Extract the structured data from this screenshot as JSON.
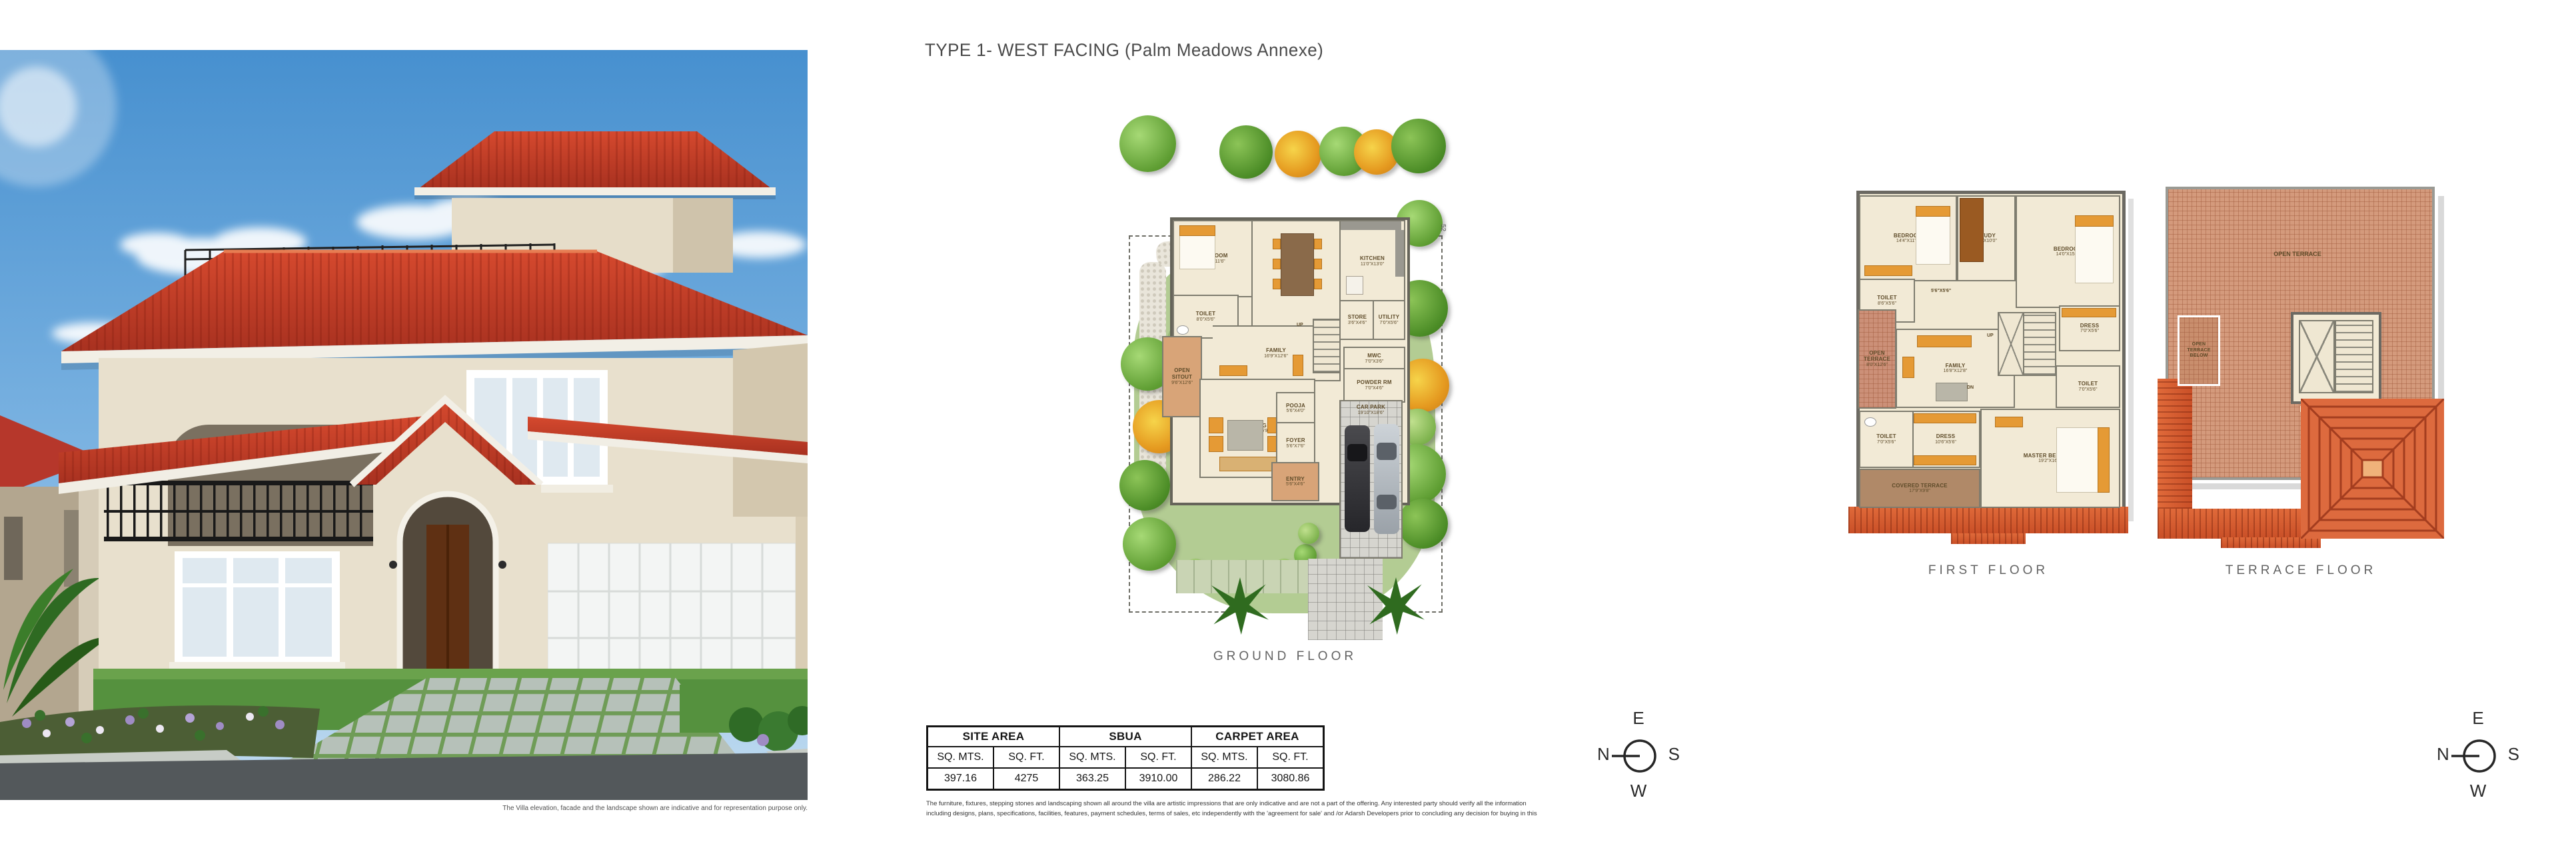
{
  "page_title": "TYPE 1- WEST FACING (Palm Meadows Annexe)",
  "villa": {
    "caption": "The Villa elevation, facade and the landscape shown are indicative and for representation purpose only."
  },
  "floors": {
    "ground": {
      "label": "GROUND FLOOR",
      "plot_no": "52"
    },
    "first": {
      "label": "FIRST FLOOR"
    },
    "terrace": {
      "label": "TERRACE FLOOR"
    }
  },
  "ground_rooms": [
    {
      "name": "BEDROOM",
      "dims": "12'6\"X11'6\""
    },
    {
      "name": "TOILET",
      "dims": "8'0\"X5'6\""
    },
    {
      "name": "DINING",
      "dims": "12'0\"X17'4\""
    },
    {
      "name": "KITCHEN",
      "dims": "11'0\"X13'0\""
    },
    {
      "name": "STORE",
      "dims": "3'6\"X4'6\""
    },
    {
      "name": "UTILITY",
      "dims": "7'0\"X5'6\""
    },
    {
      "name": "FAMILY",
      "dims": "16'9\"X12'6\""
    },
    {
      "name": "OPEN SITOUT",
      "dims": "9'6\"X12'6\""
    },
    {
      "name": "LIVING",
      "dims": "15'0\"X16'9\""
    },
    {
      "name": "POOJA",
      "dims": "5'6\"X4'0\""
    },
    {
      "name": "FOYER",
      "dims": "5'6\"X7'6\""
    },
    {
      "name": "ENTRY",
      "dims": "5'6\"X4'6\""
    },
    {
      "name": "POWDER RM",
      "dims": "7'0\"X4'6\""
    },
    {
      "name": "MWC",
      "dims": "7'0\"X3'6\""
    },
    {
      "name": "CAR PARK",
      "dims": "19'10\"X18'6\""
    },
    {
      "name": "UP"
    }
  ],
  "first_rooms": [
    {
      "name": "BEDROOM",
      "dims": "14'4\"X11'6\""
    },
    {
      "name": "STUDY",
      "dims": "8'0\"X10'0\""
    },
    {
      "name": "BEDROOM",
      "dims": "14'0\"X15'4\""
    },
    {
      "name": "TOILET",
      "dims": "8'6\"X5'6\""
    },
    {
      "name": "DRESS",
      "dims": "7'0\"X5'6\""
    },
    {
      "name": "OPEN TERRACE",
      "dims": "8'0\"X12'6\""
    },
    {
      "name": "FAMILY",
      "dims": "16'8\"X12'8\""
    },
    {
      "name": "TOILET",
      "dims": "7'0\"X5'6\""
    },
    {
      "name": "DRESS",
      "dims": "10'6\"X5'6\""
    },
    {
      "name": "TOILET",
      "dims": "7'0\"X5'6\""
    },
    {
      "name": "MASTER BEDROOM",
      "dims": "19'2\"X16'8\""
    },
    {
      "name": "COVERED TERRACE",
      "dims": "17'9\"X9'8\""
    },
    {
      "name": "UP"
    },
    {
      "name": "DN"
    },
    {
      "dims": "5'6\"X5'6\""
    }
  ],
  "terrace_rooms": [
    {
      "name": "OPEN TERRACE"
    },
    {
      "name": "OPEN TERRACE BELOW"
    },
    {
      "name": "DN"
    }
  ],
  "area_table": {
    "units": {
      "mts": "SQ. MTS.",
      "ft": "SQ. FT."
    },
    "groups": [
      {
        "label": "SITE AREA",
        "sq_mts": "397.16",
        "sq_ft": "4275"
      },
      {
        "label": "SBUA",
        "sq_mts": "363.25",
        "sq_ft": "3910.00"
      },
      {
        "label": "CARPET AREA",
        "sq_mts": "286.22",
        "sq_ft": "3080.86"
      }
    ]
  },
  "disclaimer": {
    "line1": "The furniture, fixtures, stepping stones and landscaping shown all around the villa are artistic impressions that are only indicative and are not a part of the offering. Any interested party should verify all the information",
    "line2": "including designs, plans, specifications, facilities, features, payment schedules, terms of sales, etc independently with the 'agreement for sale' and /or Adarsh Developers prior to concluding any decision for buying in this"
  },
  "compass": {
    "top": "E",
    "right": "S",
    "bottom": "W",
    "left": "N"
  },
  "palette": {
    "roof_red": "#c5402a",
    "lawn_green": "#b3cc93",
    "terrace_tile": "#cc9078",
    "plan_beige": "#f2ead6",
    "accent_orange": "#e59a35",
    "sky_blue": "#4790cf"
  }
}
